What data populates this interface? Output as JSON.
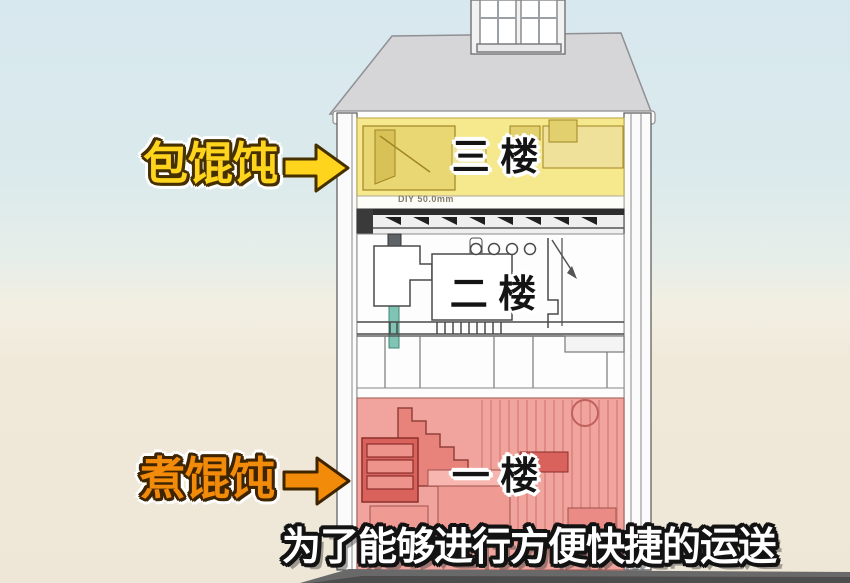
{
  "labels": {
    "wrap_wonton": "包馄饨",
    "cook_wonton": "煮馄饨",
    "floor3": "三 楼",
    "floor2": "二 楼",
    "floor1": "一 楼",
    "dimension_note": "DIY 50.0mm",
    "subtitle": "为了能够进行方便快捷的运送"
  },
  "colors": {
    "label_yellow": "#ffd41c",
    "label_orange": "#f28a0a",
    "outline_dark_yellow": "#463000",
    "outline_dark_orange": "#3f2400",
    "floor3_fill": "#f6e88d",
    "floor3_furniture": "#e9d773",
    "floor3_furniture_dark": "#d8c258",
    "floor1_fill": "#f1a49d",
    "floor1_furniture": "#d9625c",
    "floor1_furniture_light": "#ef9a93",
    "roof_fill": "#d6d6d8",
    "wall_fill": "#fbfbfb",
    "base_fill": "#696969",
    "teal_accent": "#7fc4b4",
    "sky_top": "#d7e8ee",
    "ground": "#eee7d7"
  }
}
